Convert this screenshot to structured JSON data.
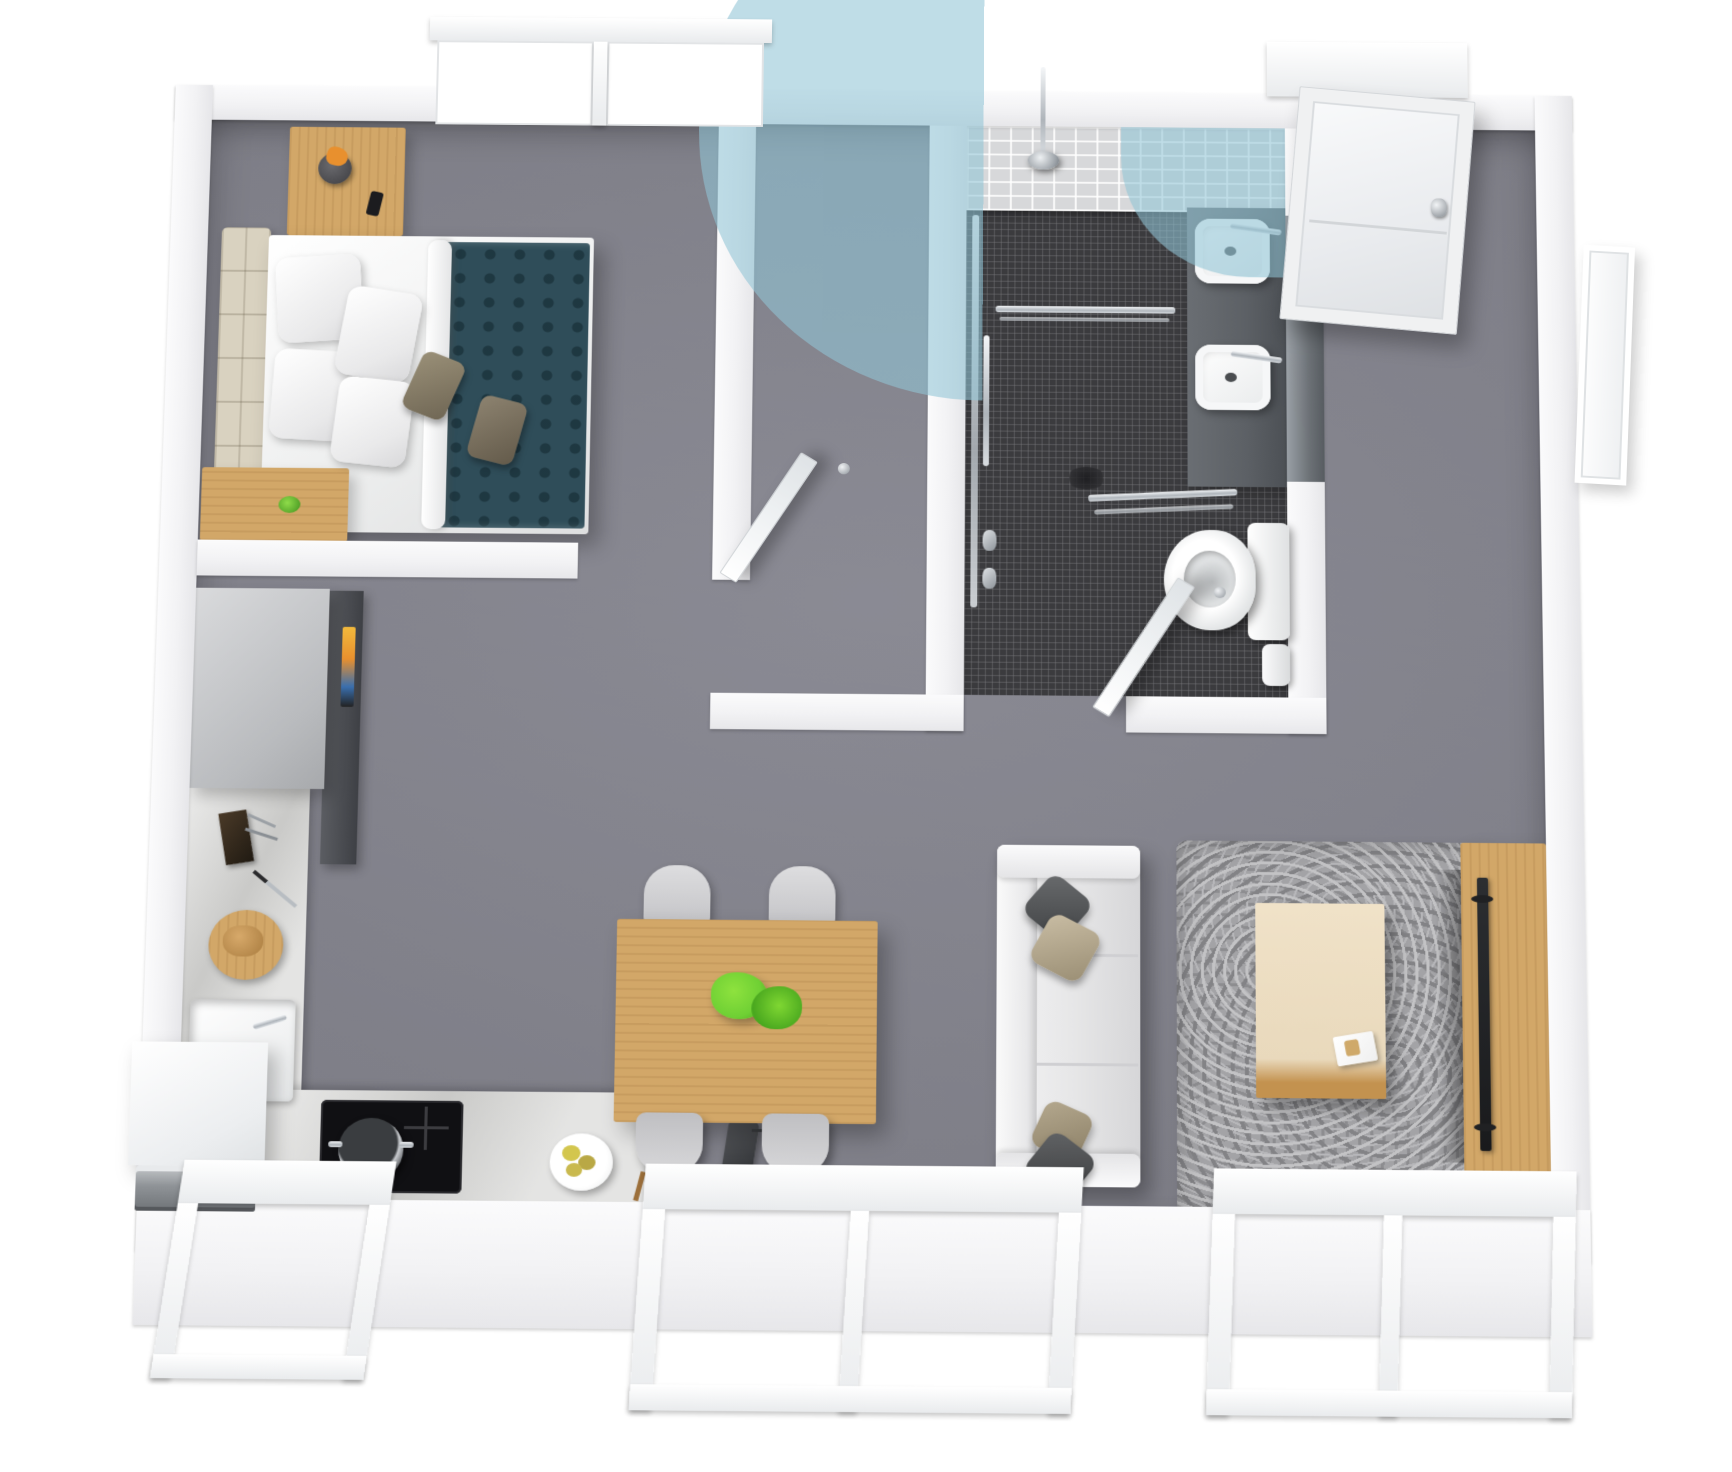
{
  "meta": {
    "view": "3d-isometric-floor-plan",
    "background": "#ffffff",
    "visible_text": "none"
  },
  "colors": {
    "page": "#ffffff",
    "floor": "#84848e",
    "wall": "#f2f2f4",
    "mosaic": "#3b3b3e",
    "tile": "#d7d8da",
    "woodLight": "#d2a768",
    "woodMid": "#c3924f",
    "teal": "#2f4d59",
    "beige": "#d9d2c0",
    "taupe": "#8f8575",
    "sofa": "#e6e6e7",
    "rug": "#a3a3a6",
    "vanity": "#5c6065",
    "chrome": "#c9ccd0",
    "accentBlue": "rgba(144,196,213,0.58)",
    "plantGreen": "#6fd034",
    "flowerOrange": "#e8902e",
    "fruitYellow": "#d3c64e",
    "screenGlow": "#f2b93c"
  },
  "overlay": {
    "shape": "coverage-circle",
    "color": "rgba(144,196,213,0.58)",
    "location": "top-wall-and-shower"
  },
  "labels": {
    "bedroom": "bedroom",
    "bathroom": "bathroom",
    "kitchen": "kitchen",
    "dining": "dining-area",
    "living": "living-area",
    "entry": "entry",
    "bed": "double-bed",
    "headboard": "upholstered-headboard",
    "nightstand": "nightstand",
    "flowerpot": "flower-pot",
    "phone": "smartphone",
    "desk": "wooden-desk",
    "bedroomTv": "wall-mounted-tv",
    "shower": "walk-in-shower",
    "showerHead": "rain-shower-head",
    "towelBar": "towel-bar",
    "grabBar": "grab-bar",
    "vanity": "double-sink-vanity",
    "sink": "vessel-sink",
    "mirror": "mirror-cabinet",
    "toilet": "toilet",
    "bin": "waste-bin",
    "tallCabinet": "tall-cabinet-fridge",
    "hood": "range-hood-cabinet",
    "oven": "built-in-oven",
    "cooktop": "induction-cooktop",
    "pot": "cooking-pot",
    "kitchenSink": "kitchen-sink",
    "knifeBlock": "knife-block",
    "cuttingBoard": "cutting-board",
    "fruitPlate": "fruit-plate",
    "counter": "kitchen-counter",
    "diningTable": "dining-table",
    "chair": "dining-chair",
    "centerPlant": "centerpiece-plant",
    "sofa": "sofa",
    "sofaPillow": "throw-pillow",
    "rug": "area-rug",
    "coffeeTable": "coffee-table",
    "magazine": "magazine",
    "tvStand": "tv-stand",
    "tv": "television",
    "device": "floor-device",
    "frontDoor": "front-door",
    "interiorDoor": "interior-door",
    "window": "window"
  },
  "rooms": [
    {
      "name": "bedroom",
      "furniture": [
        "double-bed",
        "upholstered-headboard",
        "nightstand",
        "flower-pot",
        "smartphone",
        "wooden-desk",
        "desk-plant",
        "wall-mounted-tv"
      ]
    },
    {
      "name": "bathroom",
      "furniture": [
        "walk-in-shower",
        "rain-shower-head",
        "towel-bar",
        "grab-bars",
        "double-sink-vanity",
        "mirror-cabinet",
        "toilet",
        "waste-bin"
      ]
    },
    {
      "name": "kitchen",
      "furniture": [
        "tall-cabinet-fridge",
        "range-hood-cabinet",
        "built-in-oven",
        "induction-cooktop",
        "cooking-pot",
        "kitchen-sink",
        "knife-block",
        "cutting-board",
        "fruit-plate"
      ]
    },
    {
      "name": "dining-area",
      "furniture": [
        "dining-table",
        "dining-chair",
        "dining-chair",
        "dining-chair",
        "dining-chair",
        "centerpiece-plant"
      ]
    },
    {
      "name": "living-area",
      "furniture": [
        "sofa",
        "throw-pillow",
        "area-rug",
        "coffee-table",
        "magazine",
        "tv-stand",
        "television",
        "floor-device"
      ]
    },
    {
      "name": "entry",
      "furniture": [
        "front-door"
      ]
    }
  ],
  "windows": [
    {
      "id": "top-window",
      "panes": 2,
      "wall": "north"
    },
    {
      "id": "kitchen-window",
      "panes": 1,
      "wall": "south-west"
    },
    {
      "id": "living-window-left",
      "panes": 2,
      "wall": "south"
    },
    {
      "id": "living-window-right",
      "panes": 2,
      "wall": "south"
    },
    {
      "id": "side-window",
      "panes": 1,
      "wall": "east"
    }
  ],
  "doors": [
    {
      "id": "front-door",
      "state": "closed"
    },
    {
      "id": "bedroom-door",
      "state": "open"
    },
    {
      "id": "bathroom-door",
      "state": "open"
    }
  ]
}
